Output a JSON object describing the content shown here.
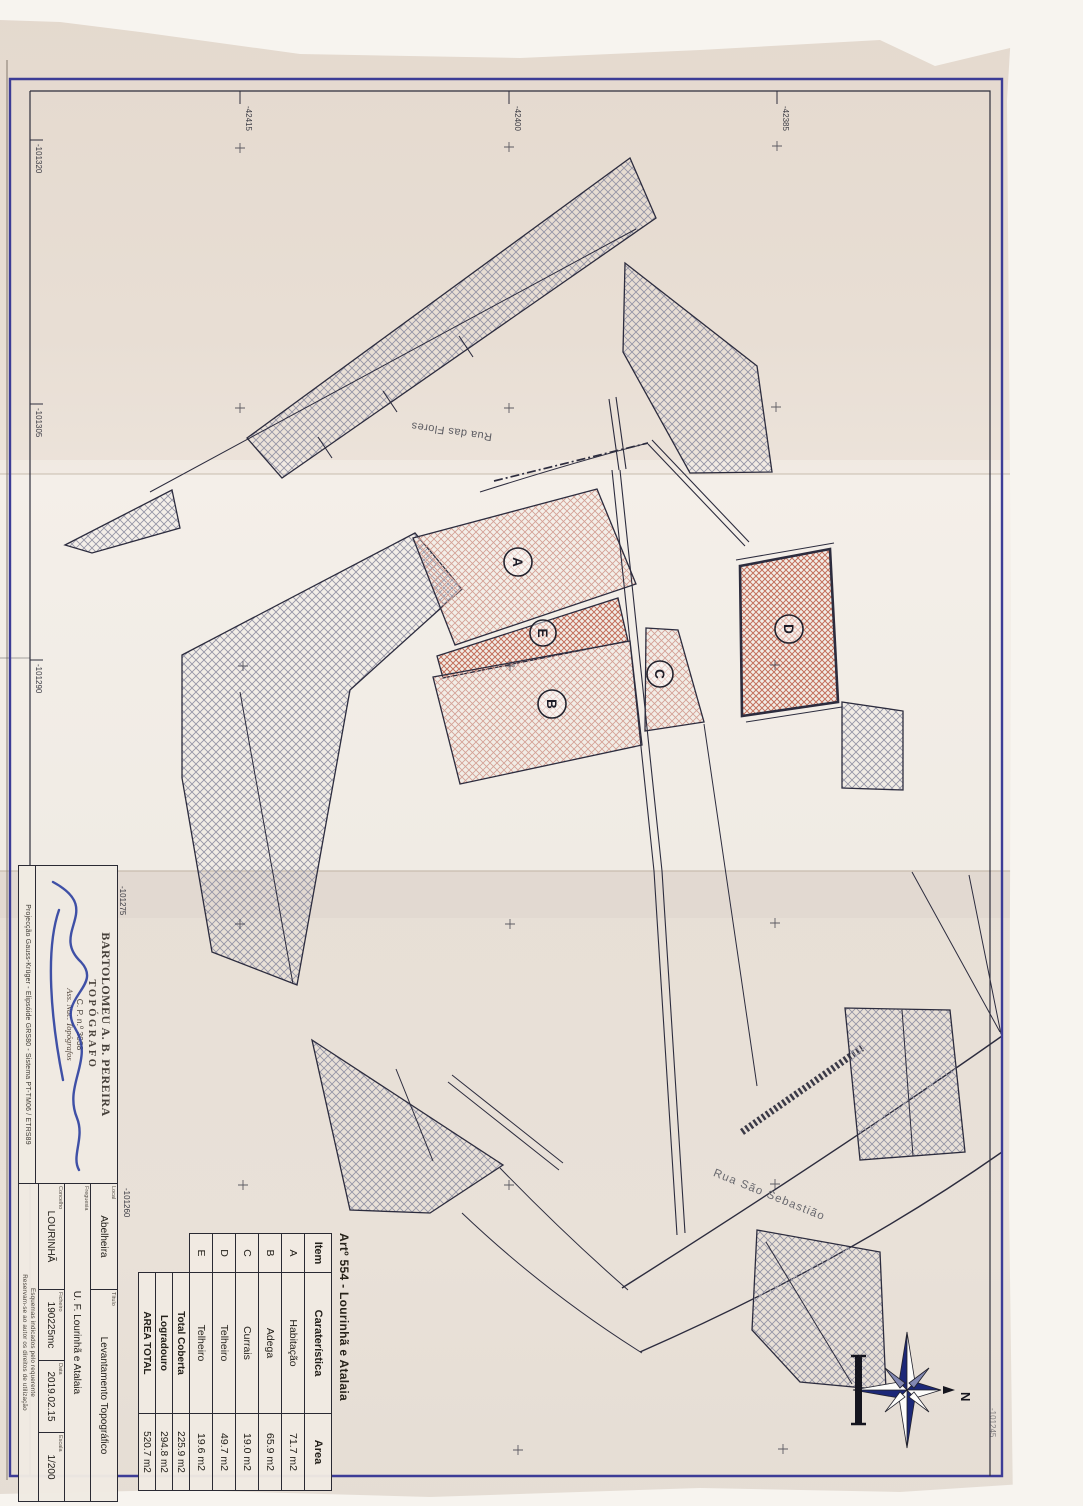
{
  "sheet": {
    "plan_title": "Artº 554 - Lourinhã e Atalaia",
    "areas_table": {
      "headers": {
        "item": "Item",
        "caracteristica": "Caraterística",
        "area": "Area"
      },
      "rows": [
        {
          "item": "A",
          "caracteristica": "Habitação",
          "area": "71.7 m2"
        },
        {
          "item": "B",
          "caracteristica": "Adega",
          "area": "65.9 m2"
        },
        {
          "item": "C",
          "caracteristica": "Currais",
          "area": "19.0 m2"
        },
        {
          "item": "D",
          "caracteristica": "Telheiro",
          "area": "49.7 m2"
        },
        {
          "item": "E",
          "caracteristica": "Telheiro",
          "area": "19.6 m2"
        }
      ],
      "totals": [
        {
          "label": "Total Coberta",
          "area": "225.9 m2"
        },
        {
          "label": "Logradouro",
          "area": "294.8 m2"
        },
        {
          "label": "AREA TOTAL",
          "area": "520.7 m2"
        }
      ]
    },
    "title_block": {
      "stamp": {
        "name": "BARTOLOMEU A. B. PEREIRA",
        "role": "TOPÓGRAFO",
        "number": "C. P. n.º 3038",
        "association": "Ass. Nac. Topógrafos"
      },
      "projection_note": "Projecção Gauss-Krüger - Elipsóide GRS80 - Sistema PT-TM06 / ETRS89",
      "local_label": "Local",
      "local_value": "Abelheira",
      "freguesia_label": "Freguesia",
      "freguesia_value": "U. F. Lourinhã e Atalaia",
      "concelho_label": "Concelho",
      "concelho_value": "LOURINHÃ",
      "titulo_label": "Título",
      "titulo_value": "Levantamento Topográfico",
      "ficheiro_label": "Ficheiro",
      "ficheiro_value": "190225mc",
      "data_label": "Data",
      "data_value": "2019.02.15",
      "escala_label": "Escala",
      "escala_value": "1/200",
      "fine_print_line1": "Esquemas indicados pelo requerente",
      "fine_print_line2": "Reservam-se ao autor os direitos de utilização"
    },
    "map": {
      "street_north": "Rua das Flores",
      "street_south": "Rua São Sebastião",
      "parcel_labels": {
        "a": "A",
        "b": "B",
        "c": "C",
        "d": "D",
        "e": "E"
      },
      "north_label": "N",
      "grid_labels_top": [
        "-42415",
        "-42400",
        "-42385"
      ],
      "grid_labels_left": [
        "-101320",
        "-101305",
        "-101290",
        "-101275",
        "-101260",
        "-101245"
      ]
    },
    "colors": {
      "frame_blue": "#3c3c96",
      "ink": "#2c2c3e",
      "signature_blue": "#2b3fa0",
      "hatch_gray": "#9595a6",
      "hatch_pink": "#d4a196",
      "hatch_red": "#c3705c",
      "compass_navy": "#1c2878",
      "paper_top": "#e6dbd0",
      "paper_mid": "#f1ece5",
      "paper_bottom": "#e8e0d7"
    }
  }
}
